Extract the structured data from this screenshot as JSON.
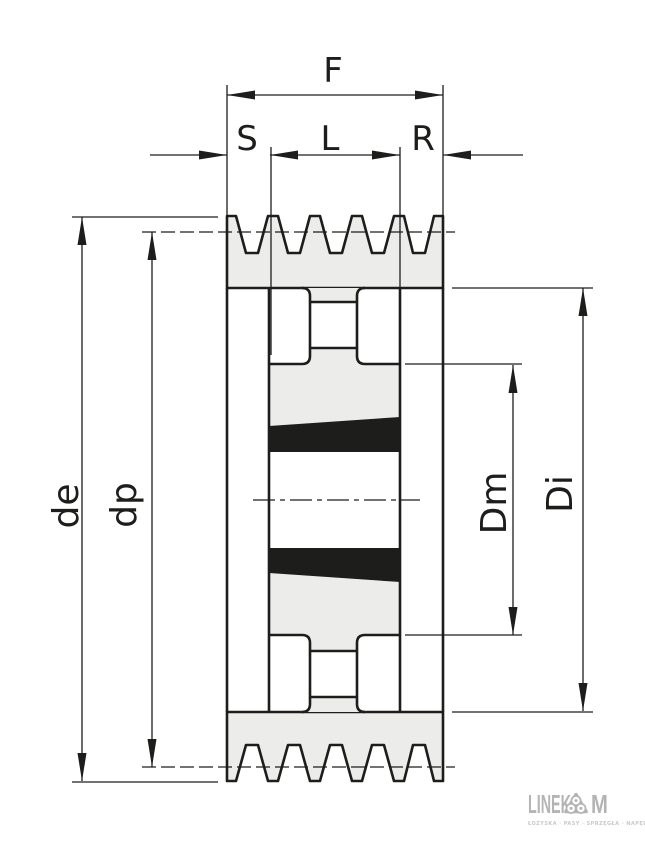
{
  "drawing": {
    "title": "v-belt-pulley-taper-bushing-cross-section",
    "labels": {
      "F": "F",
      "S": "S",
      "L": "L",
      "R": "R",
      "de": "de",
      "dp": "dp",
      "Dm": "Dm",
      "Di": "Di"
    },
    "colors": {
      "line": "#1d1d1b",
      "section_fill": "#ececeb",
      "bushing_fill": "#1d1d1b",
      "background": "#ffffff"
    }
  },
  "logo": {
    "wordmark_left": "LINEK",
    "wordmark_right": "M",
    "symbol": "bearing-rollers-icon",
    "tagline": "ŁOŻYSKA · PASY · SPRZĘGŁA · NAPĘDY",
    "color": "#b4b4b4"
  }
}
